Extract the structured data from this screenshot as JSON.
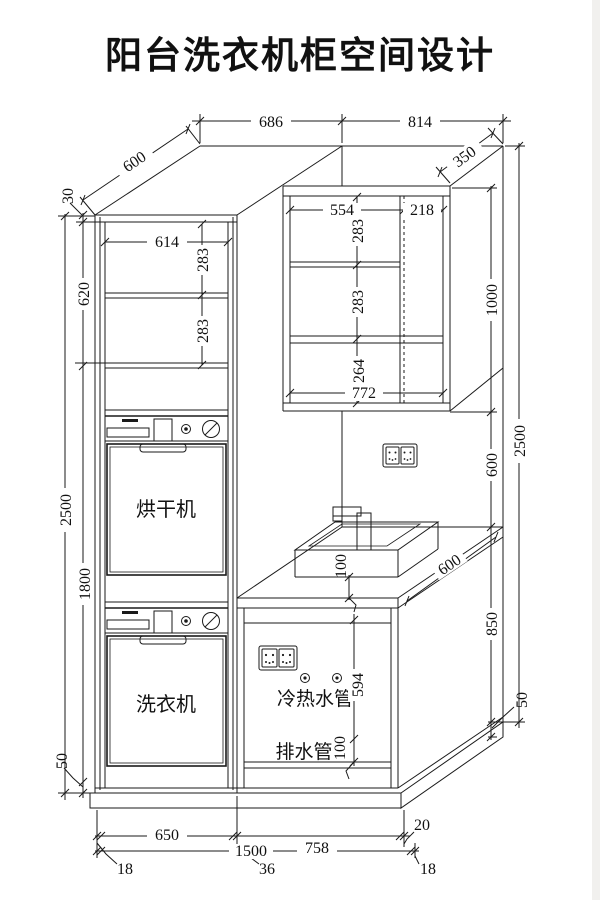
{
  "title": "阳台洗衣机柜空间设计",
  "labels": {
    "dryer": "烘干机",
    "washer": "洗衣机",
    "water_pipes": "冷热水管",
    "drain_pipe": "排水管"
  },
  "colors": {
    "line": "#1a1a1a",
    "background": "#ffffff"
  },
  "dims": {
    "top": {
      "tall_width": "686",
      "right_width": "814",
      "tall_depth": "600",
      "wall_cab_depth": "350"
    },
    "left": {
      "top_gap": "30",
      "shelf_zone": "620",
      "total_height": "2500",
      "lower_height": "1800",
      "plinth": "50"
    },
    "tall_cabinet": {
      "inner_width": "614",
      "shelf_1": "283",
      "shelf_2": "283"
    },
    "wall_cabinet": {
      "left_width": "554",
      "right_width": "218",
      "shelf_1": "283",
      "shelf_2": "283",
      "bottom_section": "264",
      "inner_width": "772",
      "height": "1000"
    },
    "right": {
      "total_height": "2500",
      "wall_gap": "600",
      "counter_height": "850",
      "plinth": "50",
      "counter_depth": "600"
    },
    "sink": {
      "offset": "100"
    },
    "pipes": {
      "water_height": "594",
      "drain_height": "100"
    },
    "bottom": {
      "left_width": "650",
      "right_width": "758",
      "total_width": "1500",
      "panel_left": "18",
      "panel_mid": "36",
      "panel_right": "18",
      "right_gap": "20"
    }
  }
}
